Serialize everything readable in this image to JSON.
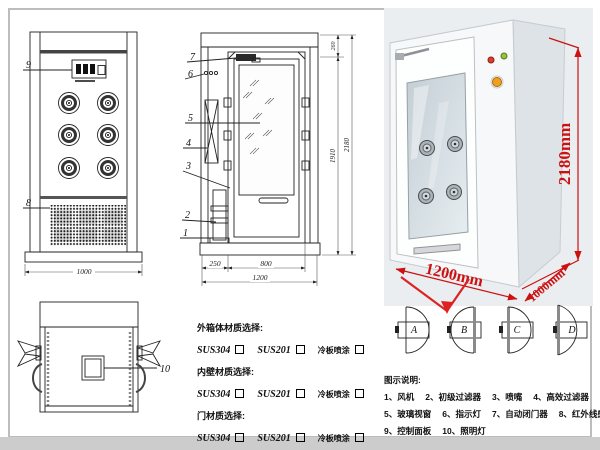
{
  "front_view": {
    "callout_9": "9",
    "callout_8": "8",
    "width_dim": "1000"
  },
  "side_view": {
    "callout_7": "7",
    "callout_6": "6",
    "callout_5": "5",
    "callout_4": "4",
    "callout_3": "3",
    "callout_2": "2",
    "callout_1": "1",
    "dim_top": "260",
    "dim_door_height": "1910",
    "dim_total_height": "2180",
    "dim_left": "250",
    "dim_door_width": "800",
    "dim_total_width": "1200"
  },
  "top_view": {
    "callout_10": "10"
  },
  "photo": {
    "dim_height": "2180mm",
    "dim_width": "1200mm",
    "dim_depth": "1000mm",
    "dim_color": "#cc1111"
  },
  "materials": {
    "sections": [
      {
        "title": "外箱体材质选择:",
        "options": [
          "SUS304",
          "SUS201",
          "冷板喷涂"
        ]
      },
      {
        "title": "内壁材质选择:",
        "options": [
          "SUS304",
          "SUS201",
          "冷板喷涂"
        ]
      },
      {
        "title": "门材质选择:",
        "options": [
          "SUS304",
          "SUS201",
          "冷板喷涂"
        ]
      }
    ]
  },
  "door_options": {
    "labels": [
      "A",
      "B",
      "C",
      "D"
    ]
  },
  "legend": {
    "title": "图示说明:",
    "rows": [
      [
        "1、风机",
        "2、初级过滤器",
        "3、喷嘴",
        "4、高效过滤器"
      ],
      [
        "5、玻璃视窗",
        "6、指示灯",
        "7、自动闭门器",
        "8、红外线感应器"
      ],
      [
        "9、控制面板",
        "10、照明灯"
      ]
    ]
  }
}
